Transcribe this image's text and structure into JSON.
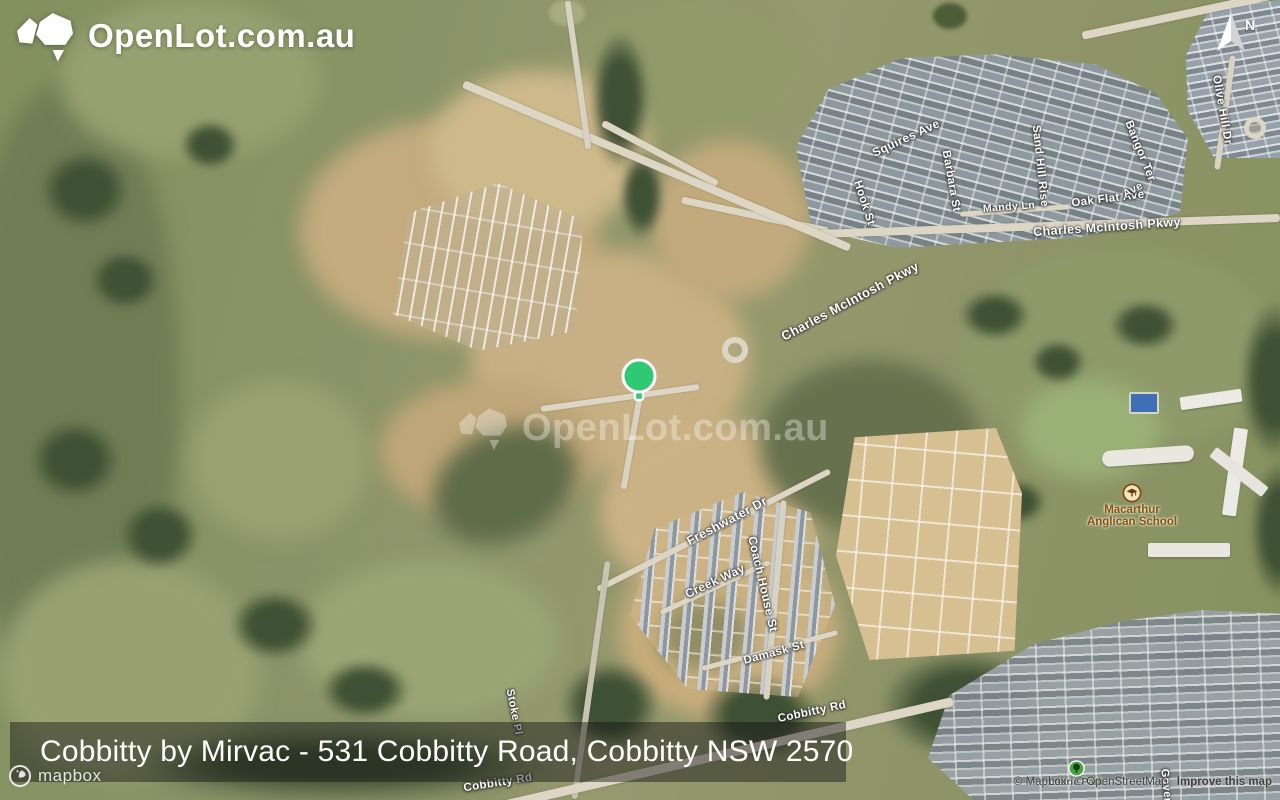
{
  "brand": {
    "logo_text": "OpenLot.com.au"
  },
  "watermark": {
    "logo_text": "OpenLot.com.au"
  },
  "compass": {
    "label": "N"
  },
  "marker": {
    "x": 638,
    "y": 376,
    "color": "#2fc873"
  },
  "caption": {
    "text": "Cobbitty by Mirvac - 531 Cobbitty Road, Cobbitty NSW 2570"
  },
  "footer": {
    "mapbox_wordmark": "mapbox",
    "attribution": {
      "mapbox": "© Mapbox",
      "osm": "© OpenStreetMap",
      "improve": "Improve this map"
    }
  },
  "colors": {
    "marker_green": "#2fc873",
    "school_label_brown": "#8a5200",
    "park_label_green": "#44523f",
    "caption_background": "rgba(18,18,18,0.45)",
    "street_label_white": "#ffffff"
  },
  "street_labels": [
    {
      "text": "Squires Ave",
      "x": 906,
      "y": 138,
      "rot": -25,
      "size": 12
    },
    {
      "text": "Hook St",
      "x": 864,
      "y": 203,
      "rot": 72,
      "size": 11.5
    },
    {
      "text": "Barbara St",
      "x": 951,
      "y": 181,
      "rot": 80,
      "size": 11.5
    },
    {
      "text": "Sand Hill Rise",
      "x": 1040,
      "y": 166,
      "rot": 84,
      "size": 11.5
    },
    {
      "text": "Mandy Ln",
      "x": 1009,
      "y": 207,
      "rot": -4,
      "size": 10.5
    },
    {
      "text": "Oak Flat Ave",
      "x": 1108,
      "y": 199,
      "rot": -7,
      "size": 11.5
    },
    {
      "text": "Charles McIntosh Pkwy",
      "x": 1107,
      "y": 227,
      "rot": -4,
      "size": 12.5
    },
    {
      "text": "Charles McIntosh Pkwy",
      "x": 850,
      "y": 301,
      "rot": -28,
      "size": 13
    },
    {
      "text": "Freshwater Dr",
      "x": 727,
      "y": 521,
      "rot": -28,
      "size": 12.5
    },
    {
      "text": "Coach House St",
      "x": 763,
      "y": 584,
      "rot": 77,
      "size": 12
    },
    {
      "text": "Creek Way",
      "x": 715,
      "y": 581,
      "rot": -25,
      "size": 12
    },
    {
      "text": "Damask St",
      "x": 774,
      "y": 653,
      "rot": -15,
      "size": 11.5
    },
    {
      "text": "Stoke Pl",
      "x": 514,
      "y": 712,
      "rot": 79,
      "size": 11
    },
    {
      "text": "Cobbitty Rd",
      "x": 498,
      "y": 783,
      "rot": -9,
      "size": 11.5
    },
    {
      "text": "Cobbitty Rd",
      "x": 812,
      "y": 712,
      "rot": -12,
      "size": 11.5
    },
    {
      "text": "Olive Hill Dr",
      "x": 1222,
      "y": 110,
      "rot": 80,
      "size": 11.5
    },
    {
      "text": "Bangor Ter",
      "x": 1140,
      "y": 151,
      "rot": 68,
      "size": 11.5
    },
    {
      "text": "Ave",
      "x": 1133,
      "y": 190,
      "rot": -28,
      "size": 11
    },
    {
      "text": "Governor",
      "x": 1167,
      "y": 795,
      "rot": 84,
      "size": 11
    }
  ],
  "place_labels": [
    {
      "lines": [
        "Macarthur",
        "Anglican School"
      ],
      "x": 1132,
      "y": 504,
      "color": "#8a5200",
      "size": 11.5
    },
    {
      "lines": [
        "Laurie Park"
      ],
      "x": 1076,
      "y": 777,
      "color": "#44523f",
      "size": 10
    }
  ]
}
